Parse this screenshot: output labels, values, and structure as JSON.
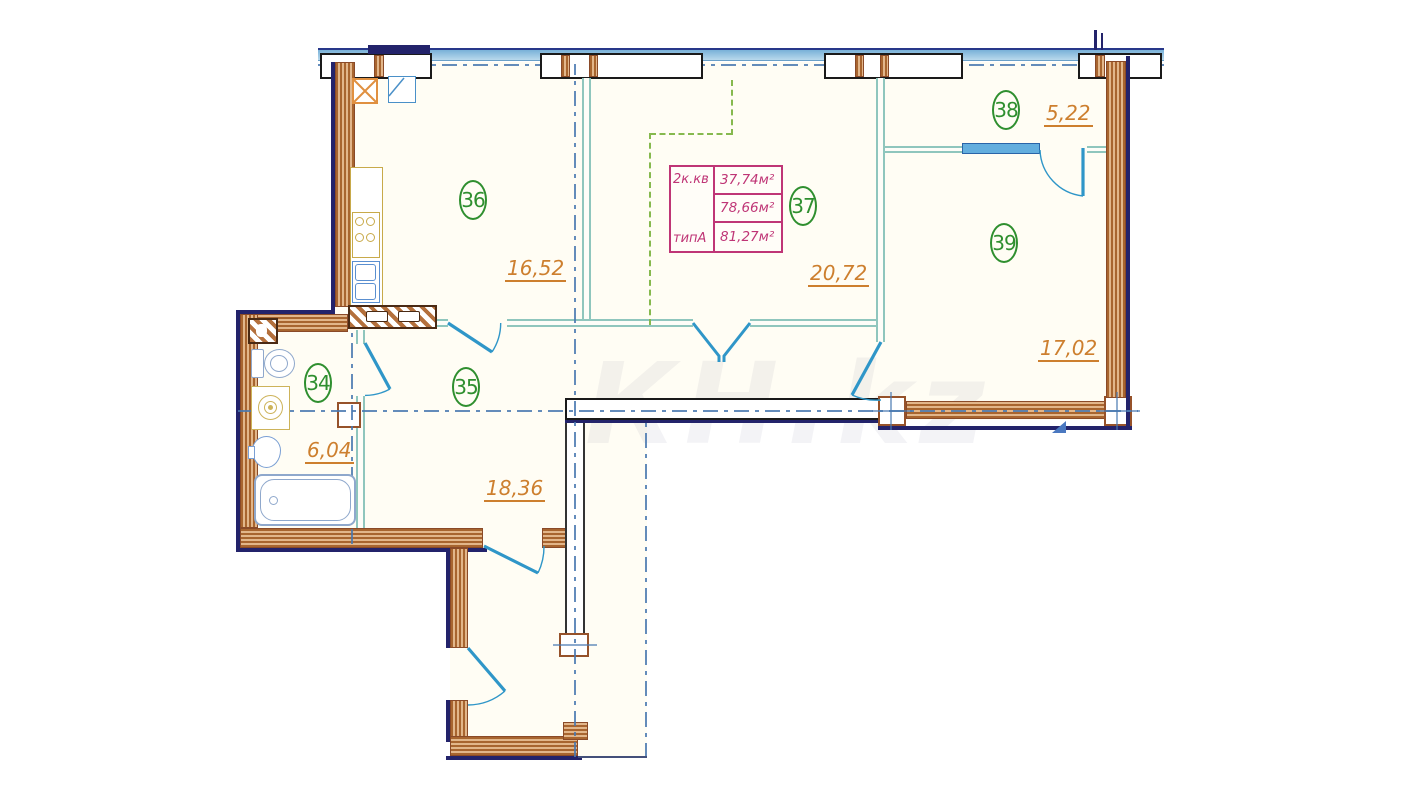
{
  "watermark": "КН.kz",
  "rooms": {
    "r34": {
      "number": "34",
      "area": "6,04"
    },
    "r35": {
      "number": "35",
      "area": "18,36"
    },
    "r36": {
      "number": "36",
      "area": "16,52"
    },
    "r37": {
      "number": "37",
      "area": "20,72"
    },
    "r38": {
      "number": "38",
      "area": "5,22"
    },
    "r39": {
      "number": "39",
      "area": "17,02"
    }
  },
  "info_table": {
    "type_label": "2к.кв",
    "plan_type_label": "типА",
    "row1_area": "37,74м²",
    "row2_area": "78,66м²",
    "row3_area": "81,27м²"
  },
  "colors": {
    "wall_brown": "#b4713c",
    "outer_edge_navy": "#23236b",
    "partition_teal": "#8fc6bd",
    "door_blue": "#2f96c8",
    "window_blue": "#63aede",
    "room_number_green": "#2f8f2f",
    "area_label_orange": "#cd7f2e",
    "info_table_magenta": "#bf3576",
    "axis_blue": "#4878b0",
    "zone_dashed_green": "#86b94e",
    "fixture_blue": "#8fa8cc",
    "fixture_yellow": "#cdb35a"
  }
}
